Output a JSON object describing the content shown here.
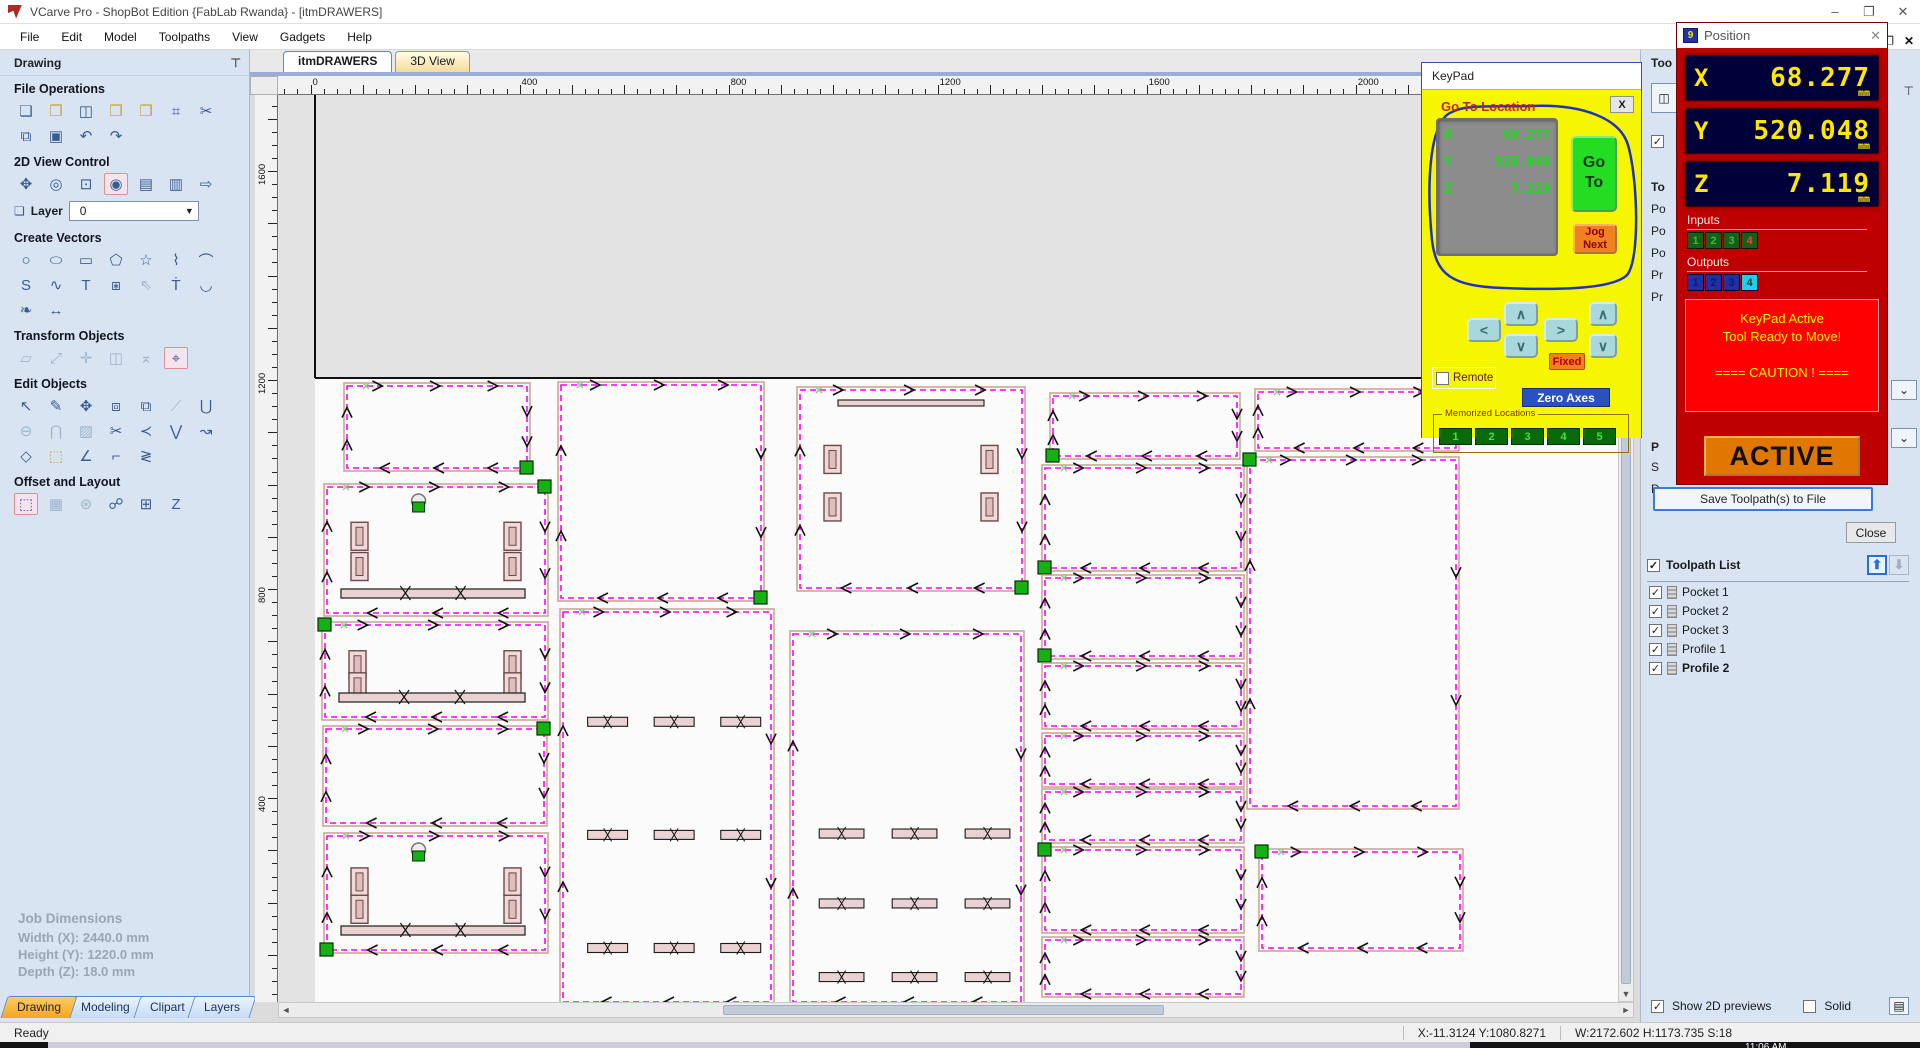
{
  "window": {
    "title": "VCarve Pro - ShopBot Edition {FabLab Rwanda} - [itmDRAWERS]",
    "controls": {
      "minimize": "–",
      "restore": "❐",
      "close": "✕"
    },
    "taskbar_clock": "11:06 AM"
  },
  "menu": [
    "File",
    "Edit",
    "Model",
    "Toolpaths",
    "View",
    "Gadgets",
    "Help"
  ],
  "view_tabs": [
    {
      "label": "itmDRAWERS",
      "active": true
    },
    {
      "label": "3D View",
      "active": false
    }
  ],
  "drawing_panel": {
    "title": "Drawing",
    "pin_icon": "⊤",
    "sections": [
      {
        "title": "File Operations",
        "icons": [
          [
            "new-file",
            "❏",
            ""
          ],
          [
            "open-file",
            "❒",
            "warm"
          ],
          [
            "save-file",
            "◫",
            ""
          ],
          [
            "import-vectors",
            "❒",
            "warm"
          ],
          [
            "export-vectors",
            "❐",
            "warm"
          ],
          [
            "job-setup",
            "⌗",
            ""
          ],
          [
            "cut",
            "✂",
            ""
          ],
          [
            "copy",
            "⧉",
            ""
          ],
          [
            "paste",
            "▣",
            ""
          ],
          [
            "undo",
            "↶",
            ""
          ],
          [
            "redo",
            "↷",
            ""
          ]
        ]
      },
      {
        "title": "2D View Control",
        "icons": [
          [
            "pan-view",
            "✥",
            ""
          ],
          [
            "zoom-interactive",
            "◎",
            ""
          ],
          [
            "zoom-box",
            "⊡",
            ""
          ],
          [
            "zoom-selected",
            "◉",
            "sel"
          ],
          [
            "zoom-drawing",
            "▤",
            ""
          ],
          [
            "zoom-sheet",
            "▥",
            ""
          ],
          [
            "switch-3d-view",
            "⇨",
            ""
          ]
        ]
      },
      {
        "title": "Create Vectors",
        "icons": [
          [
            "draw-circle",
            "○",
            ""
          ],
          [
            "draw-ellipse",
            "⬭",
            ""
          ],
          [
            "draw-rectangle",
            "▭",
            ""
          ],
          [
            "draw-polygon",
            "⬠",
            ""
          ],
          [
            "draw-star",
            "☆",
            ""
          ],
          [
            "draw-polyline",
            "⌇",
            ""
          ],
          [
            "draw-arc",
            "⌒",
            ""
          ],
          [
            "draw-curve",
            "S",
            ""
          ],
          [
            "draw-freehand",
            "∿",
            ""
          ],
          [
            "draw-text",
            "T",
            ""
          ],
          [
            "draw-text-box",
            "⧆",
            ""
          ],
          [
            "select-text",
            "⇖",
            "dim"
          ],
          [
            "text-block",
            "Ṫ",
            ""
          ],
          [
            "text-on-curve",
            "◡",
            ""
          ],
          [
            "trace-bitmap",
            "❧",
            ""
          ],
          [
            "dimension",
            "↔",
            ""
          ]
        ]
      },
      {
        "title": "Transform Objects",
        "icons": [
          [
            "move-object",
            "▱",
            "dim"
          ],
          [
            "set-size",
            "⤢",
            "dim"
          ],
          [
            "align-objects",
            "✛",
            "dim"
          ],
          [
            "mirror-object",
            "◫",
            "dim"
          ],
          [
            "distort-object",
            "⌅",
            "dim"
          ],
          [
            "free-transform",
            "⌖",
            "sel"
          ]
        ]
      },
      {
        "title": "Edit Objects",
        "icons": [
          [
            "select-vectors",
            "↖",
            ""
          ],
          [
            "node-edit",
            "✎",
            ""
          ],
          [
            "move-selection",
            "✥",
            ""
          ],
          [
            "group-objects",
            "⧈",
            ""
          ],
          [
            "ungroup-objects",
            "⧉",
            ""
          ],
          [
            "measure",
            "⟋",
            "dim"
          ],
          [
            "weld-vectors",
            "⋃",
            ""
          ],
          [
            "subtract-vectors",
            "⊖",
            "dim"
          ],
          [
            "intersect-vectors",
            "⋂",
            "dim"
          ],
          [
            "hatch-fill",
            "▨",
            "dim"
          ],
          [
            "trim-vectors",
            "✂",
            ""
          ],
          [
            "fillet-tool",
            "≺",
            ""
          ],
          [
            "join-vectors",
            "⋁",
            ""
          ],
          [
            "fit-curve",
            "↝",
            ""
          ],
          [
            "close-vector",
            "◇",
            ""
          ],
          [
            "edit-spans",
            "⬚",
            "warm"
          ],
          [
            "extend-vector",
            "∠",
            ""
          ],
          [
            "trim-to-vector",
            "⌐",
            ""
          ],
          [
            "fit-arcs",
            "≷",
            ""
          ]
        ]
      },
      {
        "title": "Offset and Layout",
        "icons": [
          [
            "offset-vectors",
            "⬚",
            "sel"
          ],
          [
            "array-copy",
            "▦",
            "dim"
          ],
          [
            "circular-copy",
            "⊛",
            "dim"
          ],
          [
            "copy-along-vector",
            "☍",
            ""
          ],
          [
            "block-copy",
            "⊞",
            ""
          ],
          [
            "nesting",
            "Z",
            ""
          ]
        ]
      }
    ],
    "layer": {
      "icon": "❏",
      "label": "Layer",
      "value": "0"
    },
    "job_dimensions": {
      "title": "Job Dimensions",
      "width": "Width  (X): 2440.0 mm",
      "height": "Height (Y): 1220.0 mm",
      "depth": "Depth  (Z): 18.0 mm"
    },
    "dock_tabs": [
      "Drawing",
      "Modeling",
      "Clipart",
      "Layers"
    ]
  },
  "rulers": {
    "top_labels": [
      0,
      400,
      800,
      1200,
      1600,
      2000
    ],
    "left_labels": [
      1600,
      1200,
      800,
      400
    ]
  },
  "keypad": {
    "title": "KeyPad",
    "close": "X",
    "goto_heading": "Go To Location",
    "lcd": [
      {
        "axis": "X",
        "value": "68.277"
      },
      {
        "axis": "Y",
        "value": "520.048"
      },
      {
        "axis": "Z",
        "value": "7.119"
      }
    ],
    "goto_button": [
      "Go",
      "To"
    ],
    "jog_button": [
      "Jog",
      "Next"
    ],
    "keys": {
      "left": "<",
      "up": "∧",
      "down": "∨",
      "right": ">",
      "z_up": "∧",
      "z_down": "∨"
    },
    "fixed": "Fixed",
    "remote": "Remote",
    "zero_axes": "Zero Axes",
    "memorized": {
      "label": "Memorized Locations",
      "buttons": [
        "1",
        "2",
        "3",
        "4",
        "5"
      ]
    }
  },
  "position": {
    "title": "Position",
    "icon_text": "9",
    "axes": [
      {
        "axis": "X",
        "value": "68.277",
        "unit": "mm"
      },
      {
        "axis": "Y",
        "value": "520.048",
        "unit": "mm"
      },
      {
        "axis": "Z",
        "value": "7.119",
        "unit": "mm"
      }
    ],
    "inputs": {
      "label": "Inputs",
      "buttons": [
        "1",
        "2",
        "3",
        "4"
      ]
    },
    "outputs": {
      "label": "Outputs",
      "buttons": [
        "1",
        "2",
        "3",
        "4"
      ]
    },
    "message": [
      "KeyPad Active",
      "Tool Ready to Move!",
      "",
      "==== CAUTION ! ===="
    ],
    "active_button": "ACTIVE"
  },
  "toolpaths_panel": {
    "title_truncated": "Too",
    "sliver_items": [
      "To",
      "Po",
      "Po",
      "Po",
      "Pr",
      "Pr",
      "P",
      "S",
      "D"
    ],
    "save_button": "Save Toolpath(s) to File",
    "close_button": "Close",
    "list": {
      "header": "Toolpath List",
      "up_icon": "⬆",
      "down_icon": "⬇",
      "items": [
        {
          "label": "Pocket 1",
          "checked": true,
          "bold": false
        },
        {
          "label": "Pocket 2",
          "checked": true,
          "bold": false
        },
        {
          "label": "Pocket 3",
          "checked": true,
          "bold": false
        },
        {
          "label": "Profile 1",
          "checked": true,
          "bold": false
        },
        {
          "label": "Profile 2",
          "checked": true,
          "bold": true
        }
      ]
    },
    "footer": {
      "show_2d": "Show 2D previews",
      "show_2d_checked": true,
      "solid": "Solid",
      "solid_checked": false
    }
  },
  "status_bar": {
    "ready": "Ready",
    "coords": "X:-11.3124 Y:1080.8271",
    "dims": "W:2172.602   H:1173.735   S:18"
  },
  "canvas": {
    "sheet": {
      "top_y": 283,
      "left_x": 37
    },
    "parts": [
      {
        "x": 69,
        "y": 291,
        "w": 180,
        "h": 82,
        "g": "br"
      },
      {
        "x": 49,
        "y": 392,
        "w": 218,
        "h": 126,
        "g": "tr",
        "slots": true,
        "hbar": true,
        "basket": true
      },
      {
        "x": 47,
        "y": 530,
        "w": 220,
        "h": 92,
        "g": "tl",
        "slots": true,
        "hbar": true
      },
      {
        "x": 48,
        "y": 634,
        "w": 218,
        "h": 94,
        "g": "tr"
      },
      {
        "x": 49,
        "y": 741,
        "w": 218,
        "h": 114,
        "g": "bl",
        "slots": true,
        "hbar": true,
        "basket": true
      },
      {
        "x": 283,
        "y": 290,
        "w": 200,
        "h": 213,
        "g": "br"
      },
      {
        "x": 285,
        "y": 517,
        "w": 208,
        "h": 390,
        "rows": [
          0.27,
          0.56,
          0.85
        ]
      },
      {
        "x": 522,
        "y": 295,
        "w": 222,
        "h": 198,
        "g": "br",
        "slots": true,
        "hbartop": true
      },
      {
        "x": 515,
        "y": 539,
        "w": 228,
        "h": 368,
        "rows": [
          0.53,
          0.72,
          0.92
        ]
      },
      {
        "x": 775,
        "y": 301,
        "w": 184,
        "h": 60,
        "g": "bl"
      },
      {
        "x": 767,
        "y": 373,
        "w": 196,
        "h": 100,
        "g": "bl"
      },
      {
        "x": 767,
        "y": 483,
        "w": 196,
        "h": 78,
        "g": "bl"
      },
      {
        "x": 767,
        "y": 571,
        "w": 196,
        "h": 60
      },
      {
        "x": 767,
        "y": 641,
        "w": 196,
        "h": 48
      },
      {
        "x": 767,
        "y": 697,
        "w": 196,
        "h": 48
      },
      {
        "x": 767,
        "y": 755,
        "w": 196,
        "h": 80,
        "g": "tl"
      },
      {
        "x": 767,
        "y": 845,
        "w": 196,
        "h": 54
      },
      {
        "x": 980,
        "y": 297,
        "w": 198,
        "h": 56
      },
      {
        "x": 972,
        "y": 365,
        "w": 206,
        "h": 346,
        "g": "tl"
      },
      {
        "x": 984,
        "y": 757,
        "w": 198,
        "h": 96,
        "g": "tl"
      }
    ]
  }
}
